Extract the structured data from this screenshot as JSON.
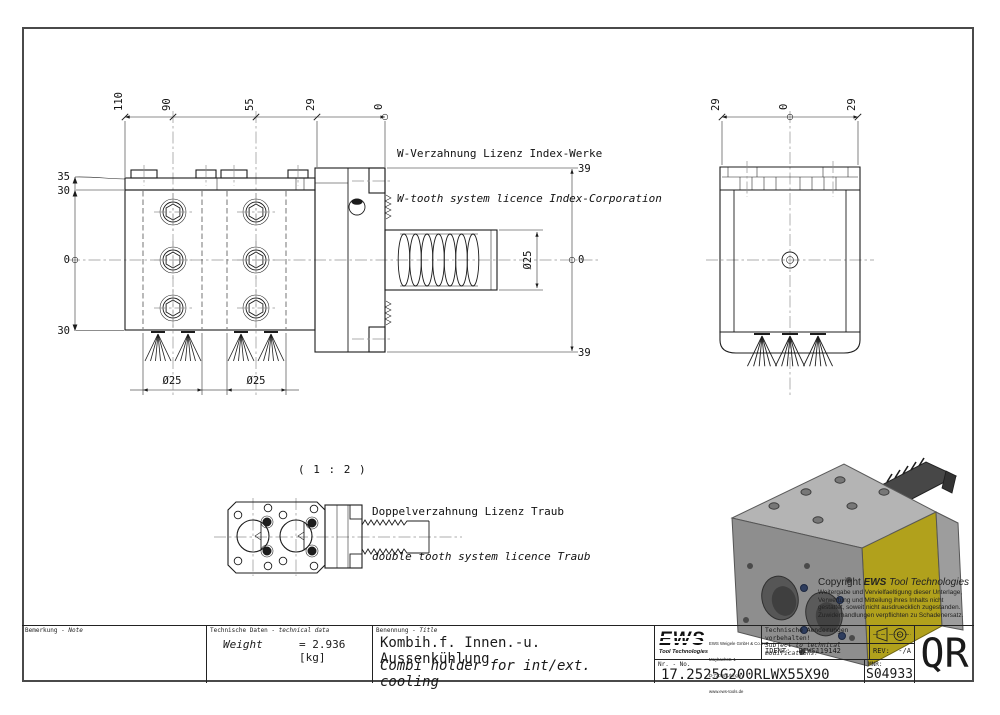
{
  "annotations": {
    "w_tooth_de": "W-Verzahnung Lizenz Index-Werke",
    "w_tooth_en": "W-tooth system licence Index-Corporation",
    "scale_label": "( 1 : 2 )",
    "double_tooth_de": "Doppelverzahnung Lizenz Traub",
    "double_tooth_en": "double tooth system licence Traub"
  },
  "dims": {
    "front_top": [
      "110",
      "90",
      "55",
      "29",
      "0"
    ],
    "front_left": [
      "35",
      "30",
      "0",
      "30"
    ],
    "front_right": [
      "39",
      "0",
      "39"
    ],
    "shaft_dia": "Ø25",
    "bore_dia_1": "Ø25",
    "bore_dia_2": "Ø25",
    "side_top": [
      "29",
      "0",
      "29"
    ]
  },
  "copyright": {
    "prefix": "Copyright ",
    "brand": "EWS",
    "suffix": " Tool Technologies",
    "body": [
      "Weitergabe und Vervielfaeltigung dieser Unterlage,",
      "Verwertung und Mitteilung ihres Inhalts nicht",
      "gestattet, soweit nicht ausdruecklich zugestanden.",
      "Zuwiderhandlungen verpflichten zu Schadenersatz."
    ]
  },
  "title_block": {
    "note_label_de": "Bemerkung - ",
    "note_label_en": "Note",
    "tech_label_de": "Technische Daten - ",
    "tech_label_en": "technical data",
    "weight_label": "Weight",
    "weight_value": "=  2.936 [kg]",
    "name_label_de": "Benennung - ",
    "name_label_en": "Title",
    "title_de": "Kombih.f. Innen.-u. Aussenkühlung",
    "title_en": "Combi holder for int/ext. cooling",
    "logo_text": "EWS",
    "logo_sub": "Tool Technologies",
    "company": [
      "EWS Weigele GmbH & Co. KG",
      "Maybachstr. 1",
      "D-73066 Uhingen",
      "www.ews-tools.de"
    ],
    "changes_de": "Technische Aenderungen vorbehalten!",
    "changes_en": "Subject to technical modifications!",
    "ident_label": "IDENT:",
    "ident_value": "DEWS119142",
    "rev_label": "REV:",
    "rev_value": "-/A",
    "nr_label": "Nr. - No.",
    "part_number": "17.2525G200RLWX55X90",
    "mnr_label": "MNR:",
    "mnr_value": "S04933",
    "qr_label": "QR"
  },
  "colors": {
    "line": "#1c1c1c",
    "centerline": "#919191",
    "render_yellow": "#b1a11c",
    "render_gray_light": "#b4b4b4",
    "render_gray": "#8e8e8e",
    "render_dark": "#474747"
  }
}
